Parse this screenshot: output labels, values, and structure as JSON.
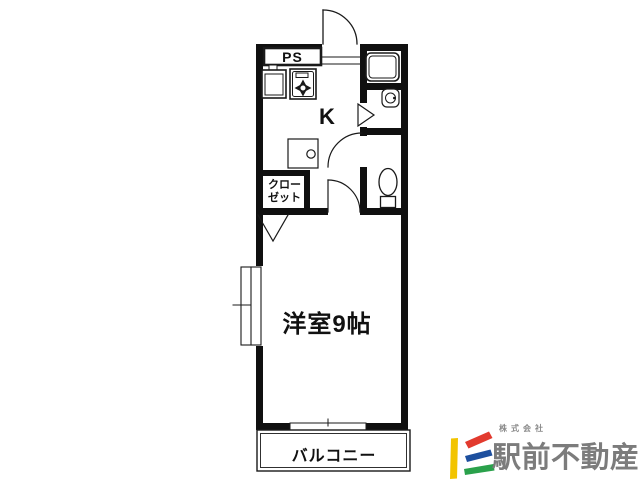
{
  "floor_plan": {
    "room_labels": {
      "pipe_space": "PS",
      "kitchen": "K",
      "closet_line1": "クロー",
      "closet_line2": "ゼット",
      "western_room": "洋室9帖",
      "balcony": "バルコニー"
    },
    "icon_names": [
      "entrance-door-swing-icon",
      "kitchen-sink-icon",
      "gas-stove-icon",
      "washing-machine-space-icon",
      "bathtub-icon",
      "washbasin-icon",
      "toilet-icon",
      "interior-door-swing-icon",
      "toilet-door-swing-icon",
      "washroom-door-mark-icon",
      "closet-door-mark-icon",
      "window-icon",
      "sliding-door-icon"
    ],
    "colors": {
      "wall": "#101010",
      "line": "#1a1a1a",
      "text": "#111111",
      "background": "#ffffff"
    }
  },
  "branding": {
    "company_prefix": "株式会社",
    "company_name": "駅前不動産",
    "text_color": "#7c7c7c",
    "logo_mark_colors": {
      "yellow": "#f2c400",
      "red": "#e23a2e",
      "blue": "#1d4f9e",
      "green": "#2aa14b"
    }
  },
  "canvas": {
    "width": 640,
    "height": 480
  }
}
